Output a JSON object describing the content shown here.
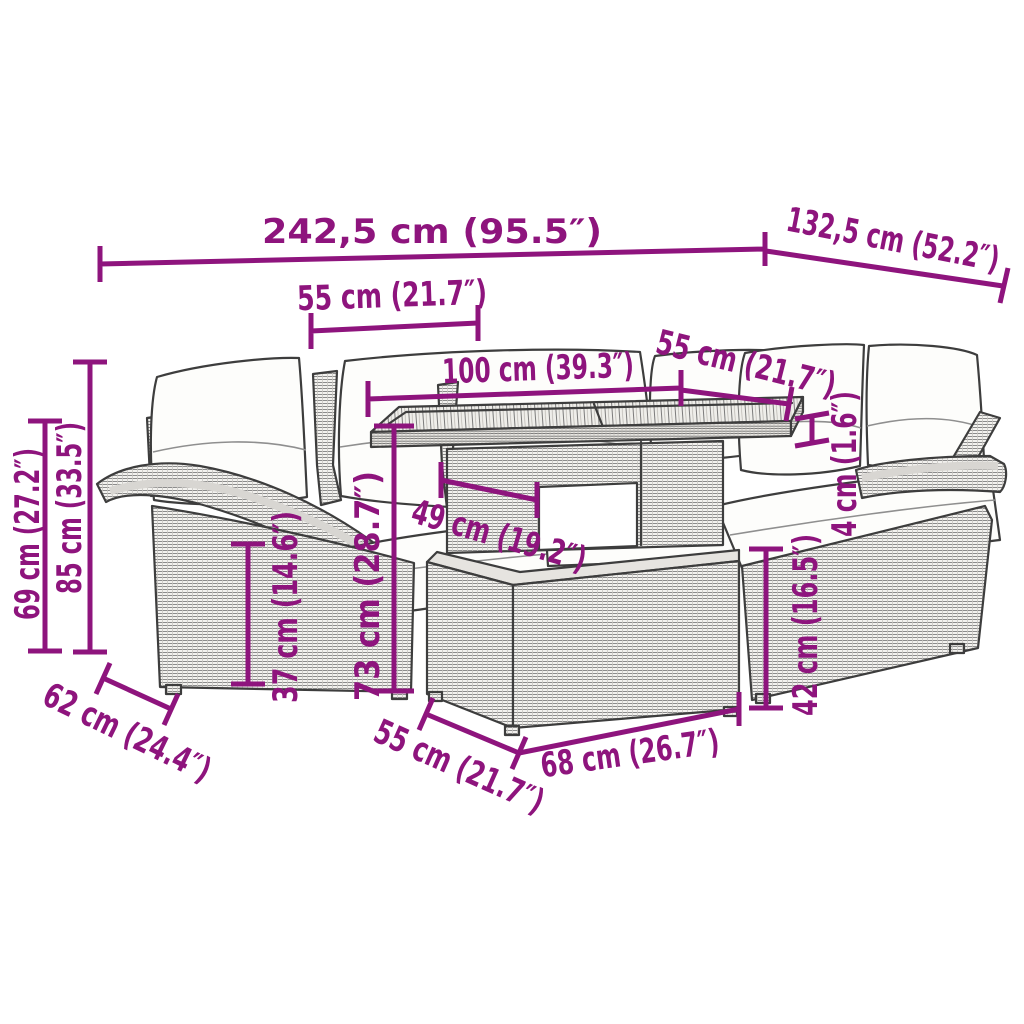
{
  "figure": {
    "type": "product-dimension-diagram",
    "subject": "poly rattan garden lounge set: corner sofa with cushions, slatted-top table and ottoman",
    "units": "cm and inches"
  },
  "colors": {
    "dimension_annotation": "#8E147D",
    "line_art": "#3d3d3d",
    "cushion_fill": "#fdfdfb",
    "background": "#ffffff"
  },
  "dims": [
    {
      "name": "total-width",
      "label": "242,5 cm (95.5″)"
    },
    {
      "name": "total-depth",
      "label": "132,5 cm (52.2″)"
    },
    {
      "name": "left-seat-width",
      "label": "55 cm (21.7″)"
    },
    {
      "name": "table-length",
      "label": "100 cm (39.3″)"
    },
    {
      "name": "right-seat-width",
      "label": "55 cm (21.7″)"
    },
    {
      "name": "armrest-height",
      "label": "69 cm (27.2″)"
    },
    {
      "name": "back-height",
      "label": "85 cm (33.5″)"
    },
    {
      "name": "seat-height",
      "label": "37 cm (14.6″)"
    },
    {
      "name": "table-height",
      "label": "73 cm (28.7″)"
    },
    {
      "name": "seat-depth-table",
      "label": "49 cm (19.2″)"
    },
    {
      "name": "tabletop-thickness",
      "label": "4 cm (1.6″)"
    },
    {
      "name": "ottoman-height",
      "label": "42 cm (16.5″)"
    },
    {
      "name": "seat-depth",
      "label": "62 cm (24.4″)"
    },
    {
      "name": "ottoman-depth",
      "label": "55 cm (21.7″)"
    },
    {
      "name": "ottoman-width",
      "label": "68 cm (26.7″)"
    }
  ]
}
